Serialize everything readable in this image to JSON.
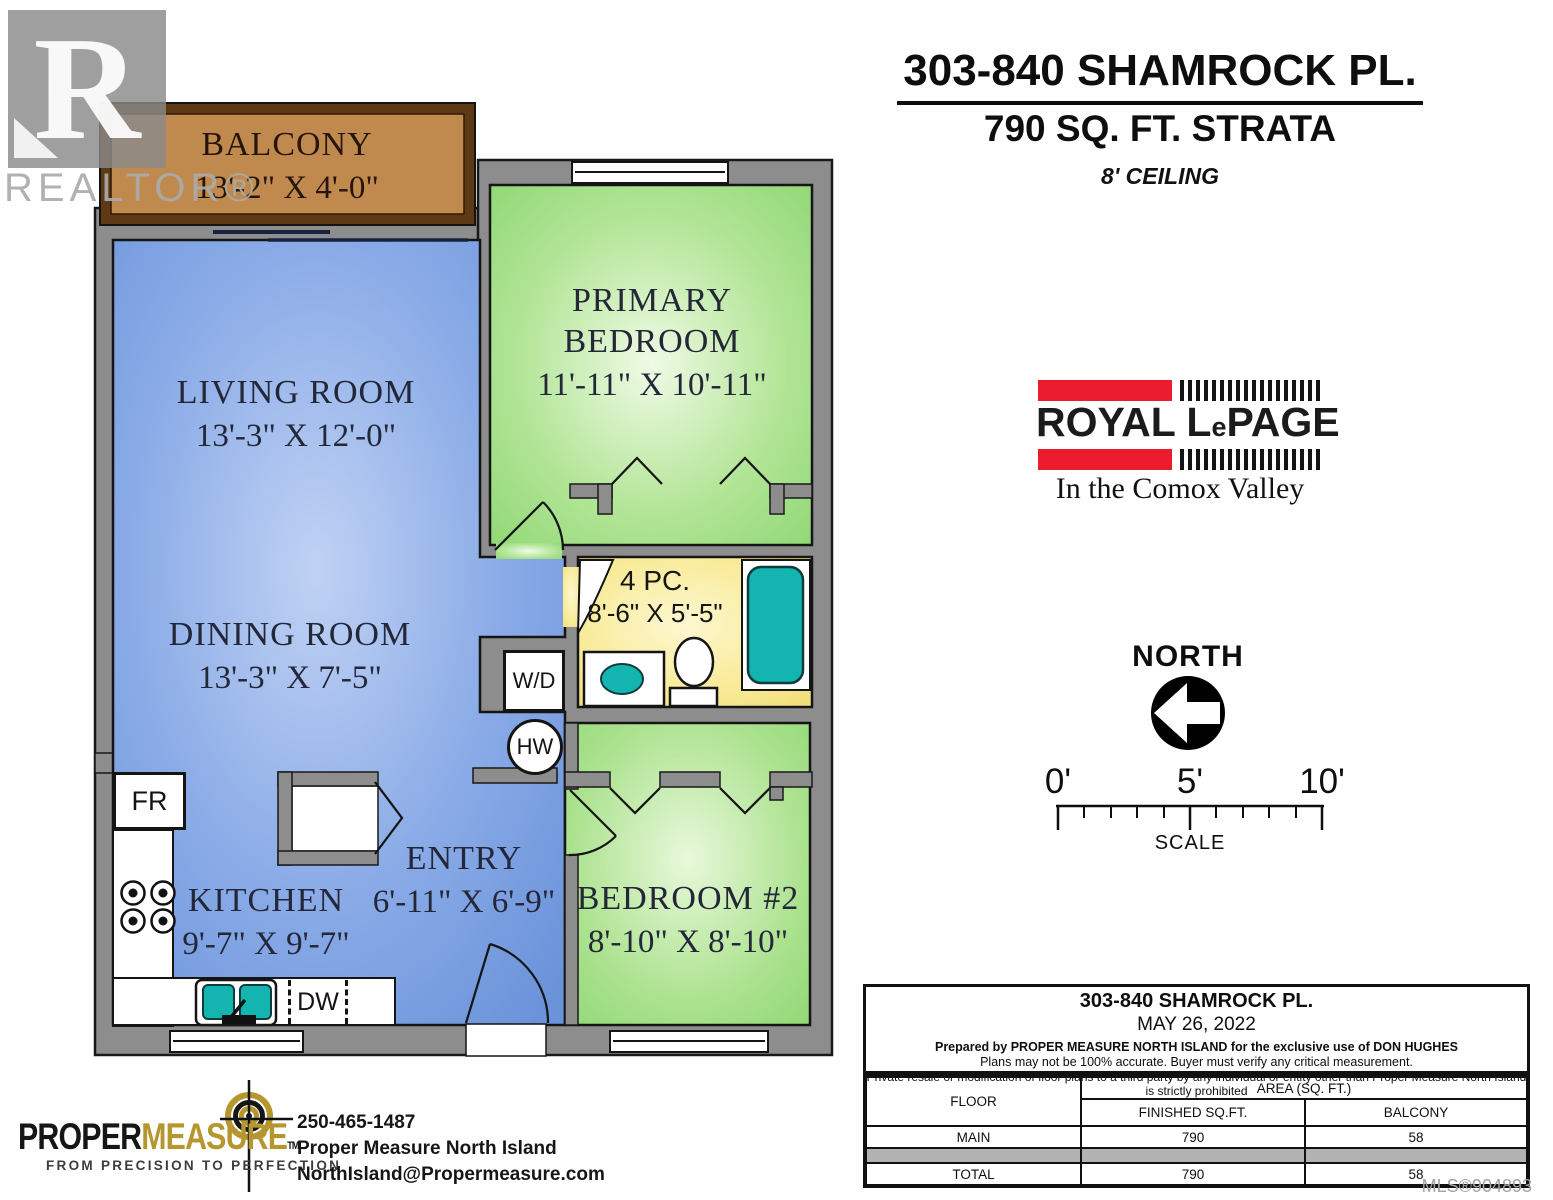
{
  "watermark": {
    "letter": "R",
    "label": "REALTOR®"
  },
  "header": {
    "title": "303-840 SHAMROCK PL.",
    "subtitle": "790 SQ. FT. STRATA",
    "ceiling": "8' CEILING"
  },
  "floorplan": {
    "balcony": {
      "name": "BALCONY",
      "dims": "13'-2\" X 4'-0\""
    },
    "living": {
      "name": "LIVING ROOM",
      "dims": "13'-3\" X 12'-0\""
    },
    "dining": {
      "name": "DINING ROOM",
      "dims": "13'-3\" X 7'-5\""
    },
    "primary": {
      "name1": "PRIMARY",
      "name2": "BEDROOM",
      "dims": "11'-11\" X 10'-11\""
    },
    "bedroom2": {
      "name": "BEDROOM #2",
      "dims": "8'-10\" X 8'-10\""
    },
    "kitchen": {
      "name": "KITCHEN",
      "dims": "9'-7\" X 9'-7\""
    },
    "entry": {
      "name": "ENTRY",
      "dims": "6'-11\" X 6'-9\""
    },
    "bathroom": {
      "name": "4 PC.",
      "dims": "8'-6\" X 5'-5\""
    },
    "fixtures": {
      "fridge": "FR",
      "washerdryer": "W/D",
      "hotwater": "HW",
      "dishwasher": "DW"
    }
  },
  "brokerage": {
    "word1": "ROYAL",
    "word2_cap": "L",
    "word2_small": "e",
    "word3": "PAGE",
    "tagline": "In the Comox Valley"
  },
  "compass": {
    "label": "NORTH"
  },
  "scalebar": {
    "t0": "0'",
    "t5": "5'",
    "t10": "10'",
    "label": "SCALE"
  },
  "infobox": {
    "address": "303-840 SHAMROCK PL.",
    "date": "MAY 26, 2022",
    "line1": "Prepared by PROPER MEASURE NORTH ISLAND for the exclusive use of DON HUGHES",
    "line2": "Plans may not be 100% accurate.  Buyer must verify any critical measurement.",
    "line3": "Private resale  or modification of floor plans to a third party by any individual or entity other than Proper Measure North Island is strictly prohibited",
    "table": {
      "floor_header": "FLOOR",
      "area_header": "AREA (SQ. FT.)",
      "finished_header": "FINISHED SQ.FT.",
      "balcony_header": "BALCONY",
      "rows": [
        {
          "floor": "MAIN",
          "finished": "790",
          "balcony": "58"
        },
        {
          "floor": "TOTAL",
          "finished": "790",
          "balcony": "58"
        }
      ]
    }
  },
  "mls": "MLS®904893",
  "propermeasure": {
    "brand1": "PROPER",
    "brand2": "MEASURE",
    "tm": "TM",
    "tagline": "FROM PRECISION TO PERFECTION",
    "phone": "250-465-1487",
    "company": "Proper Measure North Island",
    "email": "NorthIsland@Propermeasure.com"
  },
  "colors": {
    "blue": "#7fa3e4",
    "green": "#a5e08b",
    "yellow": "#f6e88f",
    "tan": "#c08a4e",
    "teal": "#14b4b0",
    "wall": "#8d8d8d",
    "red": "#ea1c2d",
    "gold": "#b6972f"
  }
}
